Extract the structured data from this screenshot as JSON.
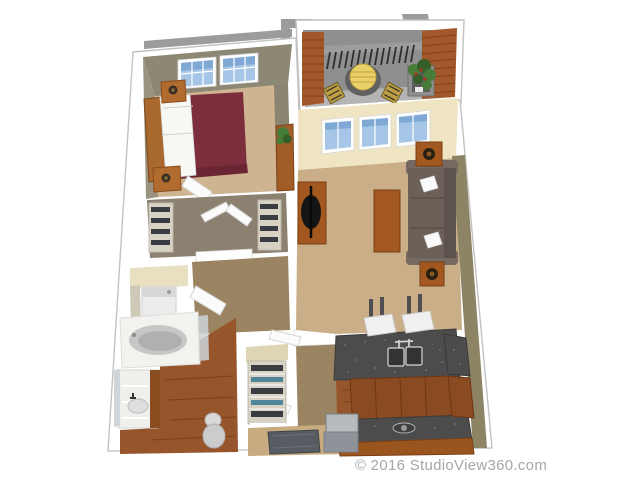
{
  "scene": {
    "kind": "3d-apartment-floor-plan-rendering",
    "rooms": [
      {
        "name": "bedroom",
        "furniture": [
          "queen-bed-maroon",
          "headboard",
          "nightstand-with-lamp",
          "nightstand-with-lamp",
          "dresser-with-plant",
          "double-window",
          "open-door"
        ]
      },
      {
        "name": "walk-in-closet",
        "furniture": [
          "shelving-left",
          "shelving-right",
          "double-doors-open"
        ]
      },
      {
        "name": "laundry-closet",
        "furniture": [
          "washer"
        ]
      },
      {
        "name": "bathroom",
        "furniture": [
          "bathtub",
          "vanity-with-sink",
          "mirror",
          "toilet",
          "open-door"
        ]
      },
      {
        "name": "linen-closet",
        "furniture": [
          "shelves-with-linens"
        ]
      },
      {
        "name": "entry",
        "furniture": [
          "door-mat"
        ]
      },
      {
        "name": "living-room",
        "furniture": [
          "sofa-with-pillows",
          "coffee-table",
          "tv-console-with-tv",
          "end-table-with-lamp",
          "end-table-with-lamp",
          "triple-window"
        ]
      },
      {
        "name": "kitchen",
        "furniture": [
          "island-with-double-sink",
          "bar-stool",
          "bar-stool",
          "range-counter",
          "appliance",
          "side-counter",
          "cabinets"
        ]
      },
      {
        "name": "patio",
        "furniture": [
          "round-table-yellow",
          "folding-chair",
          "folding-chair",
          "planter-with-plant",
          "brick-pillar",
          "brick-wall",
          "railing"
        ]
      }
    ],
    "palette": {
      "background": "#ffffff",
      "exterior_gray": "#9c9c9c",
      "wall_white": "#ffffff",
      "brick": "#a2582a",
      "patio_concrete": "#8f8f8f",
      "bedroom_carpet": "#cfb491",
      "living_carpet": "#c9ae87",
      "wall_olive": "#8d8874",
      "wall_cream": "#efe5c2",
      "hall_floor": "#9b8462",
      "wood_floor": "#96552a",
      "bed_maroon": "#7c2e3c",
      "wood_furniture": "#a3581f",
      "sofa_gray": "#6c6058",
      "granite": "#4c4c4c",
      "window_blue": "#a6c6e8",
      "table_yellow": "#e9d169",
      "mat_gray": "#575c62",
      "plant_green": "#477d38"
    }
  },
  "footer": {
    "copyright": "© 2016 StudioView360.com"
  }
}
